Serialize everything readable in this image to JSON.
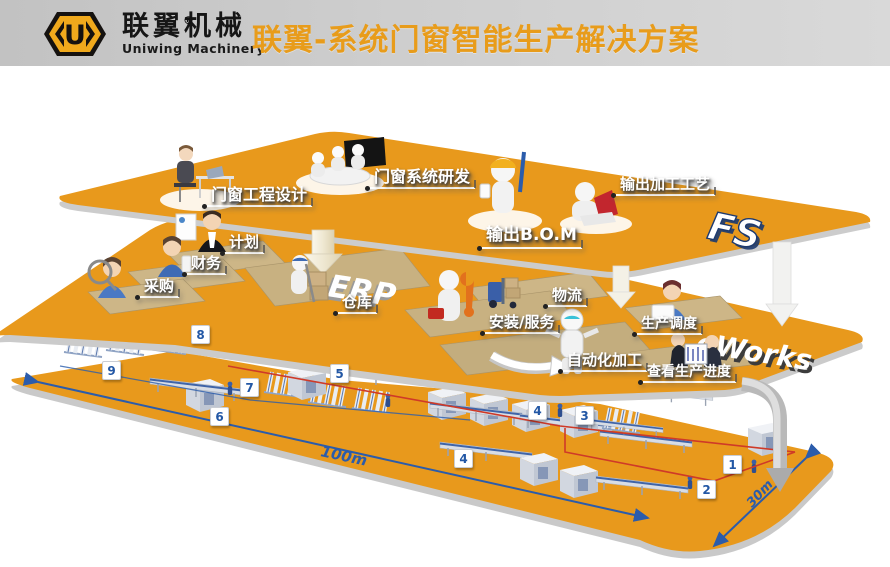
{
  "header": {
    "company_zh": "联翼机械",
    "company_en": "Uniwing Machinery",
    "registered_mark": "®",
    "logo_letter": "U",
    "title": "联翼-系统门窗智能生产解决方案"
  },
  "layer_logos": {
    "ps": "FS",
    "erp": "ERP",
    "eworks": "eWorks"
  },
  "stations": {
    "ps": [
      "门窗工程设计",
      "门窗系统研发",
      "输出B.O.M",
      "输出加工工艺"
    ],
    "erp": [
      "计划",
      "财务",
      "采购",
      "仓库",
      "物流",
      "安装/服务",
      "生产调度",
      "自动化加工",
      "查看生产进度"
    ]
  },
  "factory": {
    "station_tags": [
      "8",
      "9",
      "5",
      "7",
      "6",
      "4",
      "3",
      "4",
      "1",
      "2"
    ],
    "dimensions": {
      "length": "100m",
      "width": "30m"
    }
  },
  "colors": {
    "platform_orange": "#e8991c",
    "title_orange": "#e89c1b",
    "logo_yellow": "#f0a91c",
    "number_blue": "#2257a5",
    "dimension_blue": "#2b5cab",
    "zone_red": "#cf3a28",
    "fs_navy": "#1d3a6f"
  }
}
